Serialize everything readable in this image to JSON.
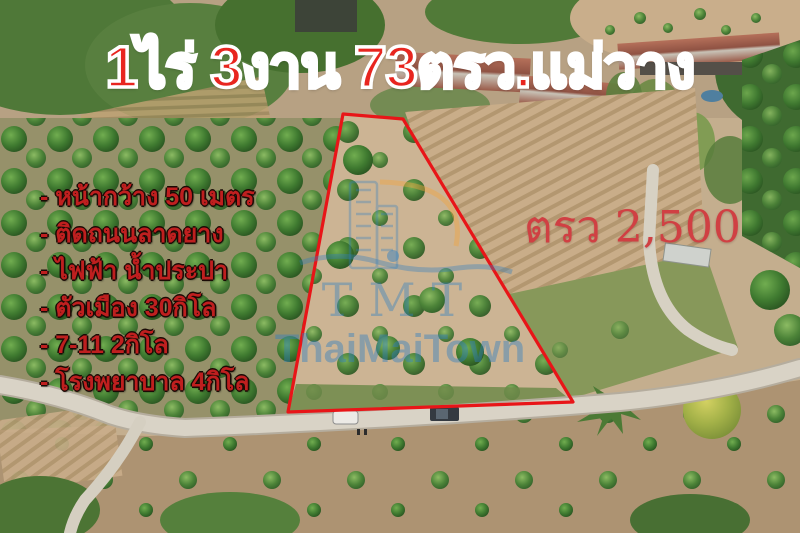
{
  "overlay": {
    "title": "1ไร่ 3งาน 73ตรว.แม่วาง",
    "features": [
      "- หน้ากว้าง 50 เมตร",
      "- ติดถนนลาดยาง",
      "- ไฟฟ้า น้ำประปา",
      "- ตัวเมือง 30กิโล",
      "- 7-11 2กิโล",
      "- โรงพยาบาล 4กิโล"
    ],
    "price_label": "ตรว 2,500",
    "watermark": {
      "initials": "TMT",
      "name": "ThaiMaiTown"
    },
    "colors": {
      "title_red": "#e8251f",
      "feature_red": "#bf1f1f",
      "price_red": "#d04043",
      "plot_outline": "#e81518",
      "watermark_blue": "#2f7fc1",
      "watermark_orange": "#f2a53d"
    }
  }
}
